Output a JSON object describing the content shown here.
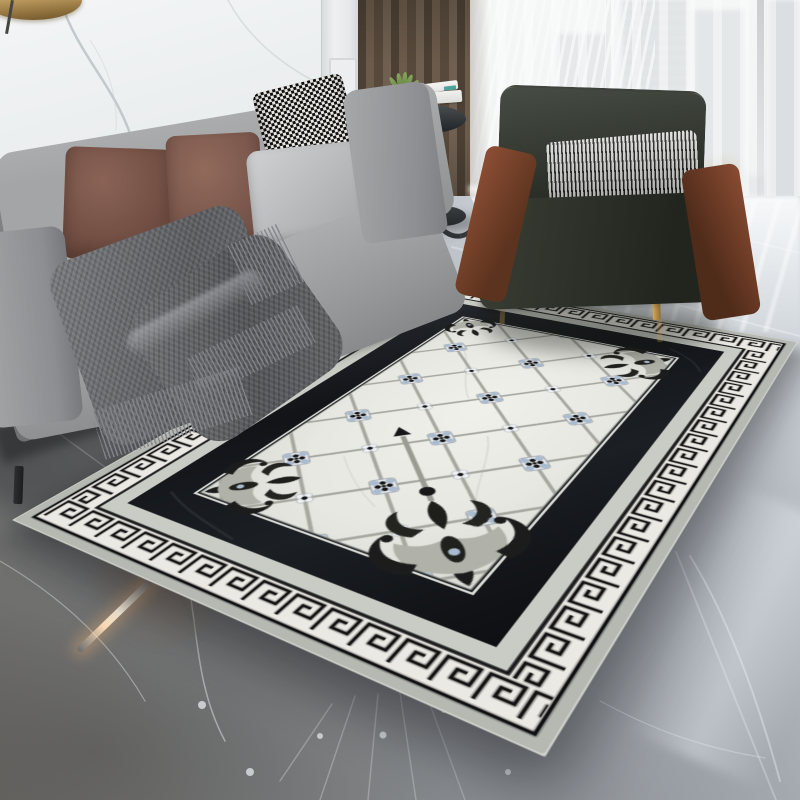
{
  "meta": {
    "description": "Product photograph: black and white neoclassical Greek-key area rug styled in a modern living room with gray marble floor",
    "canvas": {
      "width": 800,
      "height": 800
    },
    "text_visible": "none"
  },
  "labels": {
    "room": "Modern living room scene",
    "wall": "White marble accent wall with gray veining",
    "panel": "White classical wall paneling",
    "pendant": "Brass pendant lamp",
    "curtain": "Brown floor-length curtain",
    "window": "Floor-to-ceiling window with sheer curtain and city skyline view",
    "floor": "Polished gray marble floor with white veins and reflections",
    "sofa": "Light gray fabric sofa",
    "throw": "Fringed gray knit throw blanket",
    "armchair": "Dark moss velvet armchair with cognac leather arms and gold legs",
    "side_table": "Round black pedestal side table with books and succulent",
    "rug": "Black and white Greek-key bordered rug with diamond lattice field"
  },
  "palette": {
    "marble_wall": "#eaedee",
    "paneling": "#e8eaeb",
    "curtain_brown": "#5d4e41",
    "window_light": "#f6f7f6",
    "floor_gray": "#8d9196",
    "floor_dark_corner": "#6e6d6a",
    "floor_bright": "#ccd1d6",
    "sofa_gray": "#9b9c9e",
    "pillow_mauve_1": "#7d574b",
    "pillow_mauve_2": "#8a6356",
    "pillow_houndstooth": [
      "#101010",
      "#ece9e4"
    ],
    "pillow_plain_gray": "#c4c5c6",
    "throw_gray": "#66686b",
    "chair_velvet": "#2e332b",
    "chair_leather": "#7d4630",
    "chair_gold_legs": "#b08d4f",
    "lamp_brass": "#c4a365",
    "plant_green": "#6f8f56",
    "warm_reflection": "#ffdfb8"
  },
  "rug_design": {
    "shape": "rectangle in perspective, corners at (435,280) (798,342) (545,757) (12,520)",
    "outer_margin": "#b6b8b2",
    "greek_key_band": {
      "background": "#ebe9e3",
      "key_color": "#141414",
      "frame_lines": "#101012"
    },
    "marble_gray_band": "#c9cbc5",
    "inner_black_band": "#17191d",
    "field": {
      "background": "#e9e9e3",
      "lattice_lines": "#a6a79f",
      "large_medallion": {
        "tile": "#e2e5ea",
        "petals": "#a9bbce",
        "dots": "#151515",
        "count_grid": "3 x 5"
      },
      "small_medallion": {
        "petals": "#eef0f3",
        "center": "#151515"
      },
      "corner_ornaments": "black and silver baroque acanthus scrolls, largest at near corner with gray staff and dark finial"
    }
  },
  "scene_objects": [
    {
      "name": "marble-accent-wall"
    },
    {
      "name": "classical-paneling"
    },
    {
      "name": "brass-pendant-lamp"
    },
    {
      "name": "brown-curtain"
    },
    {
      "name": "sheer-window-city-view"
    },
    {
      "name": "gray-fabric-sofa",
      "pillows": [
        "mauve velvet",
        "mauve velvet",
        "black-white houndstooth",
        "plain light gray"
      ],
      "accessory": "fringed gray knit throw"
    },
    {
      "name": "round-black-side-table",
      "items": [
        "white books with teal accent",
        "succulent in white pot"
      ]
    },
    {
      "name": "velvet-leather-armchair",
      "pillow": "black-white pinstripe lumbar"
    },
    {
      "name": "greek-key-area-rug"
    },
    {
      "name": "gray-marble-floor",
      "details": [
        "white veining",
        "tile seams",
        "window reflection streaks",
        "warm lamp streak",
        "inlay star lines"
      ]
    }
  ]
}
